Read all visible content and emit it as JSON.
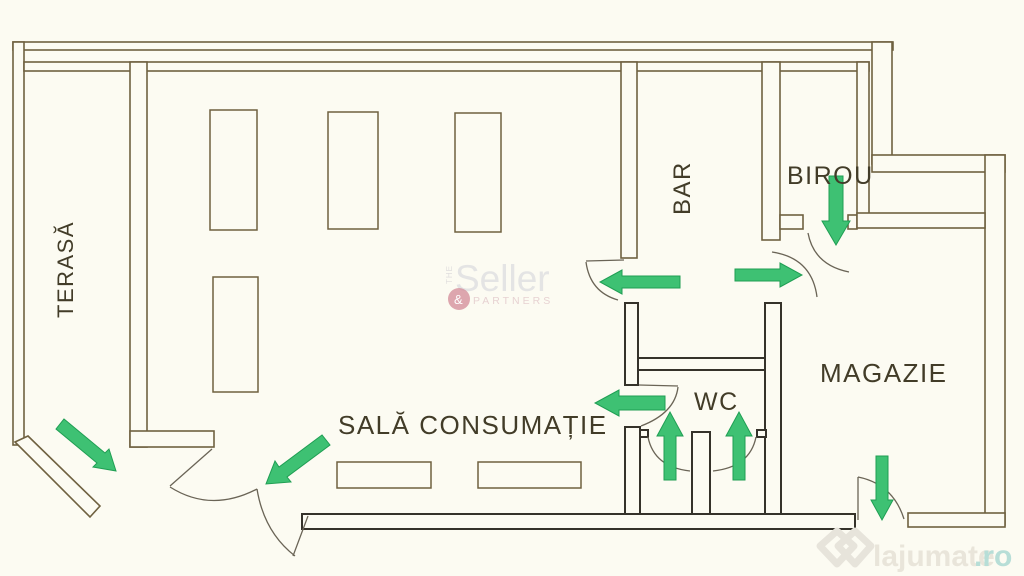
{
  "plan": {
    "title": "Floor plan of commercial space",
    "rooms": [
      {
        "id": "terasa",
        "label": "TERASĂ"
      },
      {
        "id": "bar",
        "label": "BAR"
      },
      {
        "id": "birou",
        "label": "BIROU"
      },
      {
        "id": "magazie",
        "label": "MAGAZIE"
      },
      {
        "id": "wc",
        "label": "WC"
      },
      {
        "id": "sala",
        "label": "SALĂ CONSUMAȚIE"
      }
    ],
    "arrow_count": 9
  },
  "watermarks": {
    "seller": {
      "the": "THE",
      "name": "Seller",
      "amp": "&",
      "partners": "PARTNERS"
    },
    "lajumate": {
      "name": "lajumate",
      "tld": ".ro"
    }
  },
  "colors": {
    "paper": "#fcfbf2",
    "wall_olive": "#6f6140",
    "wall_dark": "#35322a",
    "arrow_green": "#3ec173",
    "arrow_edge": "#1f9e53",
    "seller_pink": "#d4919c",
    "lajumate_teal": "#b7ded7"
  }
}
